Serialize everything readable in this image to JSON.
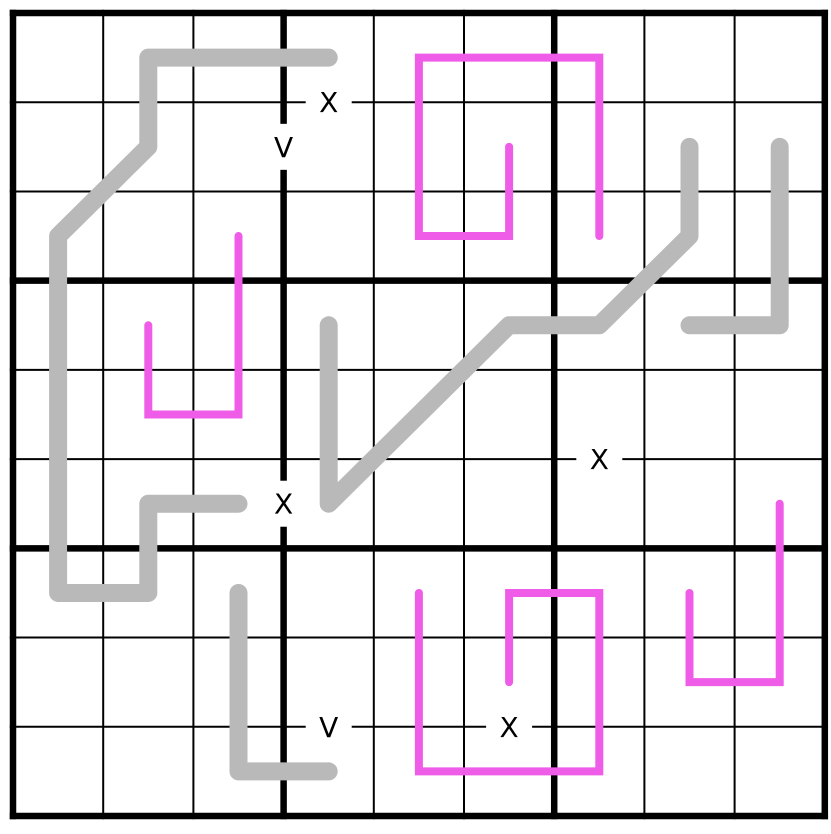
{
  "board": {
    "rows": 9,
    "cols": 9,
    "box_rows": 3,
    "box_cols": 3,
    "cell_count": 81,
    "given_digits": []
  },
  "colors": {
    "background": "#ffffff",
    "grid": "#000000",
    "gray": "#b9b9b9",
    "magenta": "#ee5ce8"
  },
  "lines": [
    {
      "id": "gray-line-1",
      "color": "gray",
      "cells": [
        [
          0,
          3
        ],
        [
          0,
          1
        ],
        [
          1,
          1
        ],
        [
          2,
          0
        ],
        [
          6,
          0
        ],
        [
          6,
          1
        ],
        [
          5,
          1
        ],
        [
          5,
          2
        ]
      ]
    },
    {
      "id": "gray-line-2",
      "color": "gray",
      "cells": [
        [
          1,
          7
        ],
        [
          2,
          7
        ],
        [
          3,
          6
        ],
        [
          3,
          5
        ],
        [
          5,
          3
        ],
        [
          3,
          3
        ]
      ]
    },
    {
      "id": "gray-line-3",
      "color": "gray",
      "cells": [
        [
          1,
          8
        ],
        [
          3,
          8
        ],
        [
          3,
          7
        ]
      ]
    },
    {
      "id": "gray-line-4",
      "color": "gray",
      "cells": [
        [
          6,
          2
        ],
        [
          8,
          2
        ],
        [
          8,
          3
        ]
      ]
    },
    {
      "id": "magenta-line-1",
      "color": "magenta",
      "cells": [
        [
          2,
          2
        ],
        [
          4,
          2
        ],
        [
          4,
          1
        ],
        [
          3,
          1
        ]
      ]
    },
    {
      "id": "magenta-line-2",
      "color": "magenta",
      "cells": [
        [
          1,
          5
        ],
        [
          2,
          5
        ],
        [
          2,
          4
        ],
        [
          0,
          4
        ],
        [
          0,
          6
        ],
        [
          2,
          6
        ]
      ]
    },
    {
      "id": "magenta-line-3",
      "color": "magenta",
      "cells": [
        [
          7,
          5
        ],
        [
          6,
          5
        ],
        [
          6,
          6
        ],
        [
          8,
          6
        ],
        [
          8,
          4
        ],
        [
          6,
          4
        ]
      ]
    },
    {
      "id": "magenta-line-4",
      "color": "magenta",
      "cells": [
        [
          6,
          7
        ],
        [
          7,
          7
        ],
        [
          7,
          8
        ],
        [
          5,
          8
        ]
      ]
    }
  ],
  "markers": [
    {
      "label": "X",
      "between": [
        [
          0,
          3
        ],
        [
          1,
          3
        ]
      ]
    },
    {
      "label": "V",
      "between": [
        [
          1,
          2
        ],
        [
          1,
          3
        ]
      ]
    },
    {
      "label": "X",
      "between": [
        [
          5,
          2
        ],
        [
          5,
          3
        ]
      ]
    },
    {
      "label": "X",
      "between": [
        [
          4,
          6
        ],
        [
          5,
          6
        ]
      ]
    },
    {
      "label": "V",
      "between": [
        [
          7,
          3
        ],
        [
          8,
          3
        ]
      ]
    },
    {
      "label": "X",
      "between": [
        [
          7,
          5
        ],
        [
          8,
          5
        ]
      ]
    }
  ]
}
